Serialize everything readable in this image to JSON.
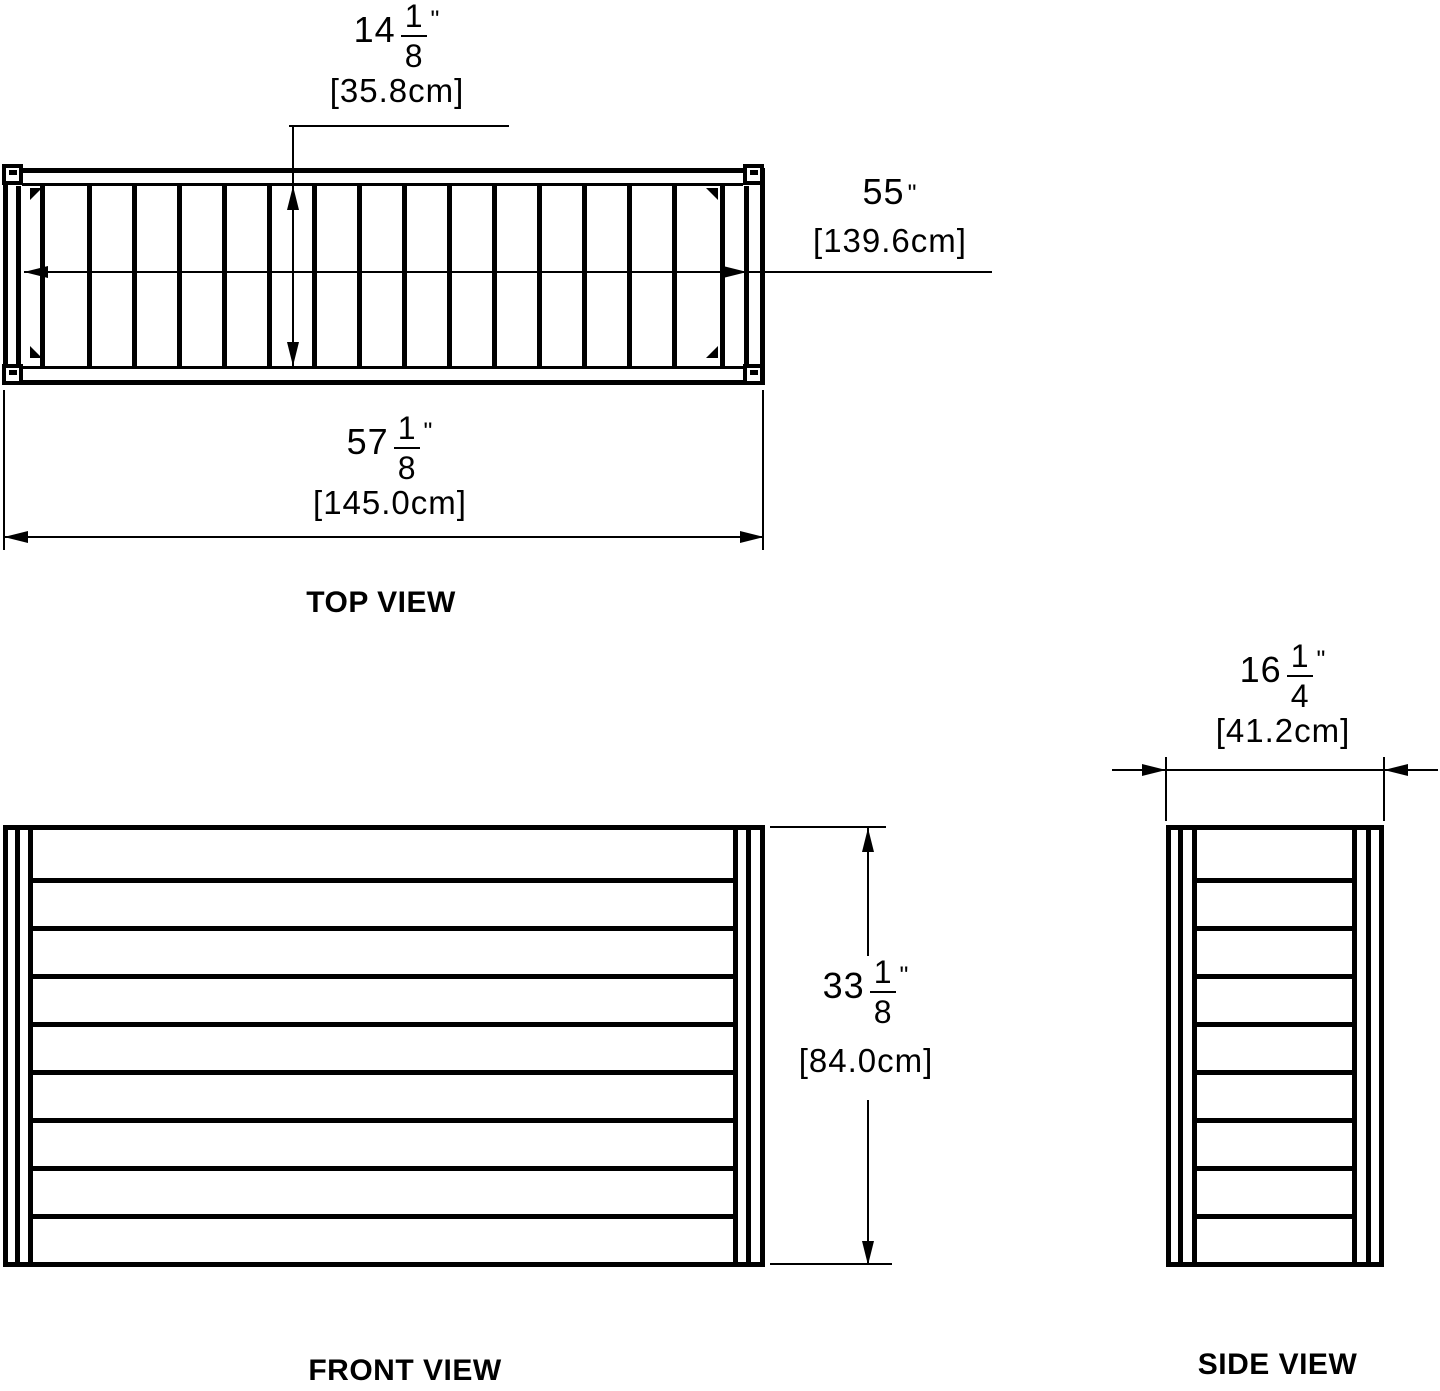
{
  "colors": {
    "line": "#000000",
    "background": "#ffffff",
    "text": "#000000"
  },
  "views": {
    "top": {
      "label": "TOP VIEW",
      "dims": {
        "depth": {
          "whole": "14",
          "num": "1",
          "den": "8",
          "unit": "\"",
          "metric": "[35.8cm]"
        },
        "inner_width": {
          "whole": "55",
          "unit": "\"",
          "metric": "[139.6cm]"
        },
        "overall_width": {
          "whole": "57",
          "num": "1",
          "den": "8",
          "unit": "\"",
          "metric": "[145.0cm]"
        }
      }
    },
    "front": {
      "label": "FRONT VIEW",
      "dims": {
        "height": {
          "whole": "33",
          "num": "1",
          "den": "8",
          "unit": "\"",
          "metric": "[84.0cm]"
        }
      }
    },
    "side": {
      "label": "SIDE VIEW",
      "dims": {
        "width": {
          "whole": "16",
          "num": "1",
          "den": "4",
          "unit": "\"",
          "metric": "[41.2cm]"
        }
      }
    }
  }
}
